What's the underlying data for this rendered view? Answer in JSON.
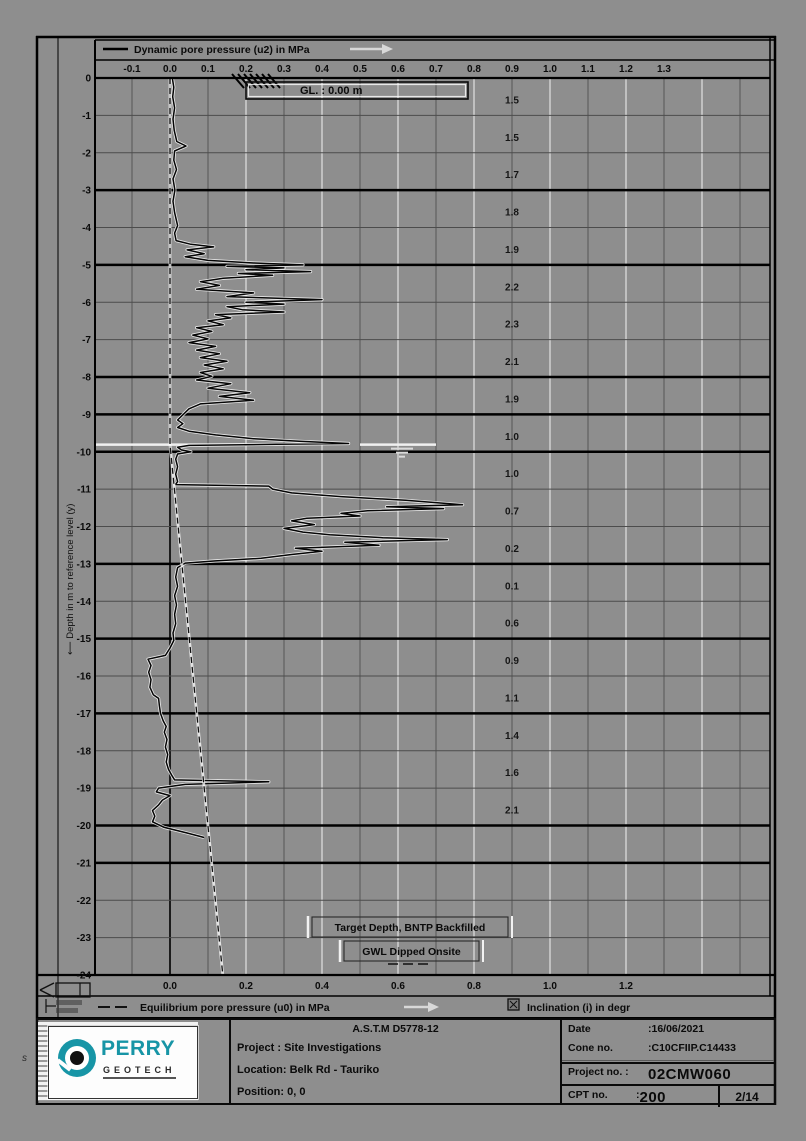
{
  "chart_data": {
    "type": "line",
    "title": "Dynamic pore pressure (u2) in MPa",
    "legend_u2": "Dynamic pore pressure (u2) in MPa",
    "legend_u0": "Equilibrium pore pressure (u0) in MPa",
    "legend_inclination": "Inclination (i) in degr",
    "ylabel": "Depth in m to reference level (y)",
    "gl_label": "GL. : 0.00 m",
    "xlabel_unit": "MPa",
    "top_ticks": [
      -0.1,
      0.0,
      0.1,
      0.2,
      0.3,
      0.4,
      0.5,
      0.6,
      0.7,
      0.8,
      0.9,
      1.0,
      1.1,
      1.2,
      1.3
    ],
    "bottom_ticks": [
      0.0,
      0.2,
      0.4,
      0.6,
      0.8,
      1.0,
      1.2
    ],
    "depth_ticks": [
      0,
      -1,
      -2,
      -3,
      -4,
      -5,
      -6,
      -7,
      -8,
      -9,
      -10,
      -11,
      -12,
      -13,
      -14,
      -15,
      -16,
      -17,
      -18,
      -19,
      -20,
      -21,
      -22,
      -23,
      -24
    ],
    "ylim": [
      0,
      -24
    ],
    "xlim": [
      -0.2,
      1.58
    ],
    "grid": "on",
    "heavy_depths": [
      3,
      5,
      8,
      9,
      10,
      13,
      15,
      17,
      20,
      21
    ],
    "gwl_depth": 9.81,
    "annotations": [
      {
        "text": "Target Depth, BNTP Backfilled",
        "depth": 24.15,
        "center_mpa": 0.63
      },
      {
        "text": "GWL Dipped Onsite",
        "depth": 24.8,
        "center_mpa": 0.63
      }
    ],
    "inclination": {
      "x_mpa": 0.9,
      "start_depth": 0.6,
      "step": 1,
      "values": [
        1.5,
        1.5,
        1.7,
        1.8,
        1.9,
        2.2,
        2.3,
        2.1,
        1.9,
        1.0,
        1.0,
        0.7,
        0.2,
        0.1,
        0.6,
        0.9,
        1.1,
        1.4,
        1.6,
        2.1
      ]
    },
    "series": [
      {
        "name": "u2_dynamic_pore_pressure",
        "style": "solid",
        "points": [
          [
            0,
            0.006
          ],
          [
            0.25,
            0.01
          ],
          [
            0.5,
            0.007
          ],
          [
            0.8,
            0.012
          ],
          [
            1.1,
            0.008
          ],
          [
            1.4,
            0.011
          ],
          [
            1.7,
            0.018
          ],
          [
            1.82,
            0.042
          ],
          [
            1.95,
            0.012
          ],
          [
            2.2,
            0.01
          ],
          [
            2.45,
            0.017
          ],
          [
            2.7,
            0.008
          ],
          [
            3.0,
            0.013
          ],
          [
            3.3,
            0.008
          ],
          [
            3.6,
            0.012
          ],
          [
            3.95,
            0.02
          ],
          [
            4.15,
            0.012
          ],
          [
            4.35,
            0.016
          ],
          [
            4.45,
            0.055
          ],
          [
            4.52,
            0.115
          ],
          [
            4.6,
            0.045
          ],
          [
            4.7,
            0.09
          ],
          [
            4.78,
            0.04
          ],
          [
            4.88,
            0.1
          ],
          [
            4.95,
            0.22
          ],
          [
            5.0,
            0.35
          ],
          [
            5.04,
            0.15
          ],
          [
            5.08,
            0.3
          ],
          [
            5.13,
            0.2
          ],
          [
            5.18,
            0.37
          ],
          [
            5.23,
            0.18
          ],
          [
            5.28,
            0.27
          ],
          [
            5.36,
            0.14
          ],
          [
            5.45,
            0.08
          ],
          [
            5.55,
            0.13
          ],
          [
            5.65,
            0.07
          ],
          [
            5.75,
            0.22
          ],
          [
            5.85,
            0.15
          ],
          [
            5.93,
            0.4
          ],
          [
            6.0,
            0.2
          ],
          [
            6.05,
            0.3
          ],
          [
            6.12,
            0.15
          ],
          [
            6.2,
            0.19
          ],
          [
            6.26,
            0.3
          ],
          [
            6.33,
            0.12
          ],
          [
            6.42,
            0.16
          ],
          [
            6.5,
            0.1
          ],
          [
            6.6,
            0.14
          ],
          [
            6.68,
            0.07
          ],
          [
            6.78,
            0.11
          ],
          [
            6.88,
            0.06
          ],
          [
            6.98,
            0.1
          ],
          [
            7.08,
            0.05
          ],
          [
            7.18,
            0.12
          ],
          [
            7.28,
            0.07
          ],
          [
            7.38,
            0.13
          ],
          [
            7.48,
            0.08
          ],
          [
            7.58,
            0.15
          ],
          [
            7.68,
            0.09
          ],
          [
            7.78,
            0.14
          ],
          [
            7.88,
            0.08
          ],
          [
            7.98,
            0.11
          ],
          [
            8.08,
            0.07
          ],
          [
            8.18,
            0.16
          ],
          [
            8.3,
            0.1
          ],
          [
            8.42,
            0.21
          ],
          [
            8.52,
            0.13
          ],
          [
            8.62,
            0.22
          ],
          [
            8.72,
            0.08
          ],
          [
            8.85,
            0.05
          ],
          [
            9.0,
            0.035
          ],
          [
            9.15,
            0.02
          ],
          [
            9.25,
            0.034
          ],
          [
            9.35,
            0.02
          ],
          [
            9.45,
            0.05
          ],
          [
            9.55,
            0.12
          ],
          [
            9.65,
            0.22
          ],
          [
            9.72,
            0.34
          ],
          [
            9.78,
            0.47
          ],
          [
            9.8,
            0.28
          ],
          [
            9.83,
            0.05
          ],
          [
            9.88,
            0.02
          ],
          [
            9.95,
            0.03
          ],
          [
            10.0,
            0.055
          ],
          [
            10.06,
            0.02
          ],
          [
            10.2,
            0.015
          ],
          [
            10.4,
            0.02
          ],
          [
            10.6,
            0.015
          ],
          [
            10.8,
            0.02
          ],
          [
            10.88,
            0.014
          ],
          [
            10.92,
            0.26
          ],
          [
            11.0,
            0.27
          ],
          [
            11.1,
            0.32
          ],
          [
            11.2,
            0.45
          ],
          [
            11.3,
            0.62
          ],
          [
            11.38,
            0.72
          ],
          [
            11.42,
            0.77
          ],
          [
            11.47,
            0.57
          ],
          [
            11.52,
            0.72
          ],
          [
            11.58,
            0.52
          ],
          [
            11.65,
            0.45
          ],
          [
            11.72,
            0.5
          ],
          [
            11.78,
            0.36
          ],
          [
            11.85,
            0.32
          ],
          [
            11.95,
            0.38
          ],
          [
            12.05,
            0.3
          ],
          [
            12.15,
            0.35
          ],
          [
            12.22,
            0.42
          ],
          [
            12.3,
            0.56
          ],
          [
            12.35,
            0.73
          ],
          [
            12.42,
            0.46
          ],
          [
            12.5,
            0.55
          ],
          [
            12.58,
            0.33
          ],
          [
            12.66,
            0.4
          ],
          [
            12.75,
            0.32
          ],
          [
            12.85,
            0.24
          ],
          [
            12.92,
            0.12
          ],
          [
            12.98,
            0.04
          ],
          [
            13.1,
            0.02
          ],
          [
            13.35,
            0.015
          ],
          [
            13.6,
            0.02
          ],
          [
            13.85,
            0.012
          ],
          [
            14.1,
            0.017
          ],
          [
            14.35,
            0.012
          ],
          [
            14.6,
            0.015
          ],
          [
            14.85,
            0.008
          ],
          [
            15.05,
            0.01
          ],
          [
            15.25,
            0
          ],
          [
            15.45,
            -0.012
          ],
          [
            15.55,
            -0.058
          ],
          [
            15.72,
            -0.05
          ],
          [
            15.9,
            -0.056
          ],
          [
            16.1,
            -0.05
          ],
          [
            16.3,
            -0.053
          ],
          [
            16.5,
            -0.044
          ],
          [
            16.6,
            -0.03
          ],
          [
            16.8,
            -0.028
          ],
          [
            17.0,
            -0.025
          ],
          [
            17.2,
            -0.018
          ],
          [
            17.35,
            -0.01
          ],
          [
            17.5,
            -0.015
          ],
          [
            17.7,
            -0.008
          ],
          [
            17.9,
            -0.012
          ],
          [
            18.1,
            -0.006
          ],
          [
            18.3,
            -0.01
          ],
          [
            18.5,
            -0.004
          ],
          [
            18.68,
            0.006
          ],
          [
            18.78,
            0.012
          ],
          [
            18.83,
            0.26
          ],
          [
            18.9,
            0.04
          ],
          [
            19.0,
            -0.03
          ],
          [
            19.1,
            -0.036
          ],
          [
            19.2,
            0
          ],
          [
            19.32,
            -0.02
          ],
          [
            19.45,
            -0.03
          ],
          [
            19.6,
            -0.046
          ],
          [
            19.75,
            -0.04
          ],
          [
            19.9,
            -0.046
          ],
          [
            20.05,
            -0.015
          ],
          [
            20.2,
            0.045
          ],
          [
            20.32,
            0.09
          ]
        ]
      },
      {
        "name": "u0_equilibrium_pore_pressure",
        "style": "dashed",
        "points": [
          [
            0,
            0
          ],
          [
            9.81,
            0
          ],
          [
            24,
            0.139
          ]
        ]
      }
    ]
  },
  "footer": {
    "astm": "A.S.T.M D5778-12",
    "sep": ":",
    "project_label": "Project :",
    "project_value": "Site Investigations",
    "location_label": "Location:",
    "location_value": "Belk Rd - Tauriko",
    "position_label": "Position:",
    "position_value": "0, 0",
    "date_label": "Date",
    "date_value": "16/06/2021",
    "cone_label": "Cone no.",
    "cone_value": "C10CFIIP.C14433",
    "projectno_label": "Project no. :",
    "projectno_value": "02CMW060",
    "cptno_label": "CPT no.",
    "cptno_value": "200",
    "page_value": "2/14"
  },
  "logo": {
    "name": "PERRY",
    "sub": "GEOTECH",
    "teal": "#1795a6"
  },
  "edge_mark": "s",
  "colors": {
    "page_bg": "#8e8e8e",
    "line": "#0a0a0a",
    "grid_dark": "#4c4c4c",
    "grid_white": "#e8e8e8",
    "accent_teal": "#1795a6"
  }
}
